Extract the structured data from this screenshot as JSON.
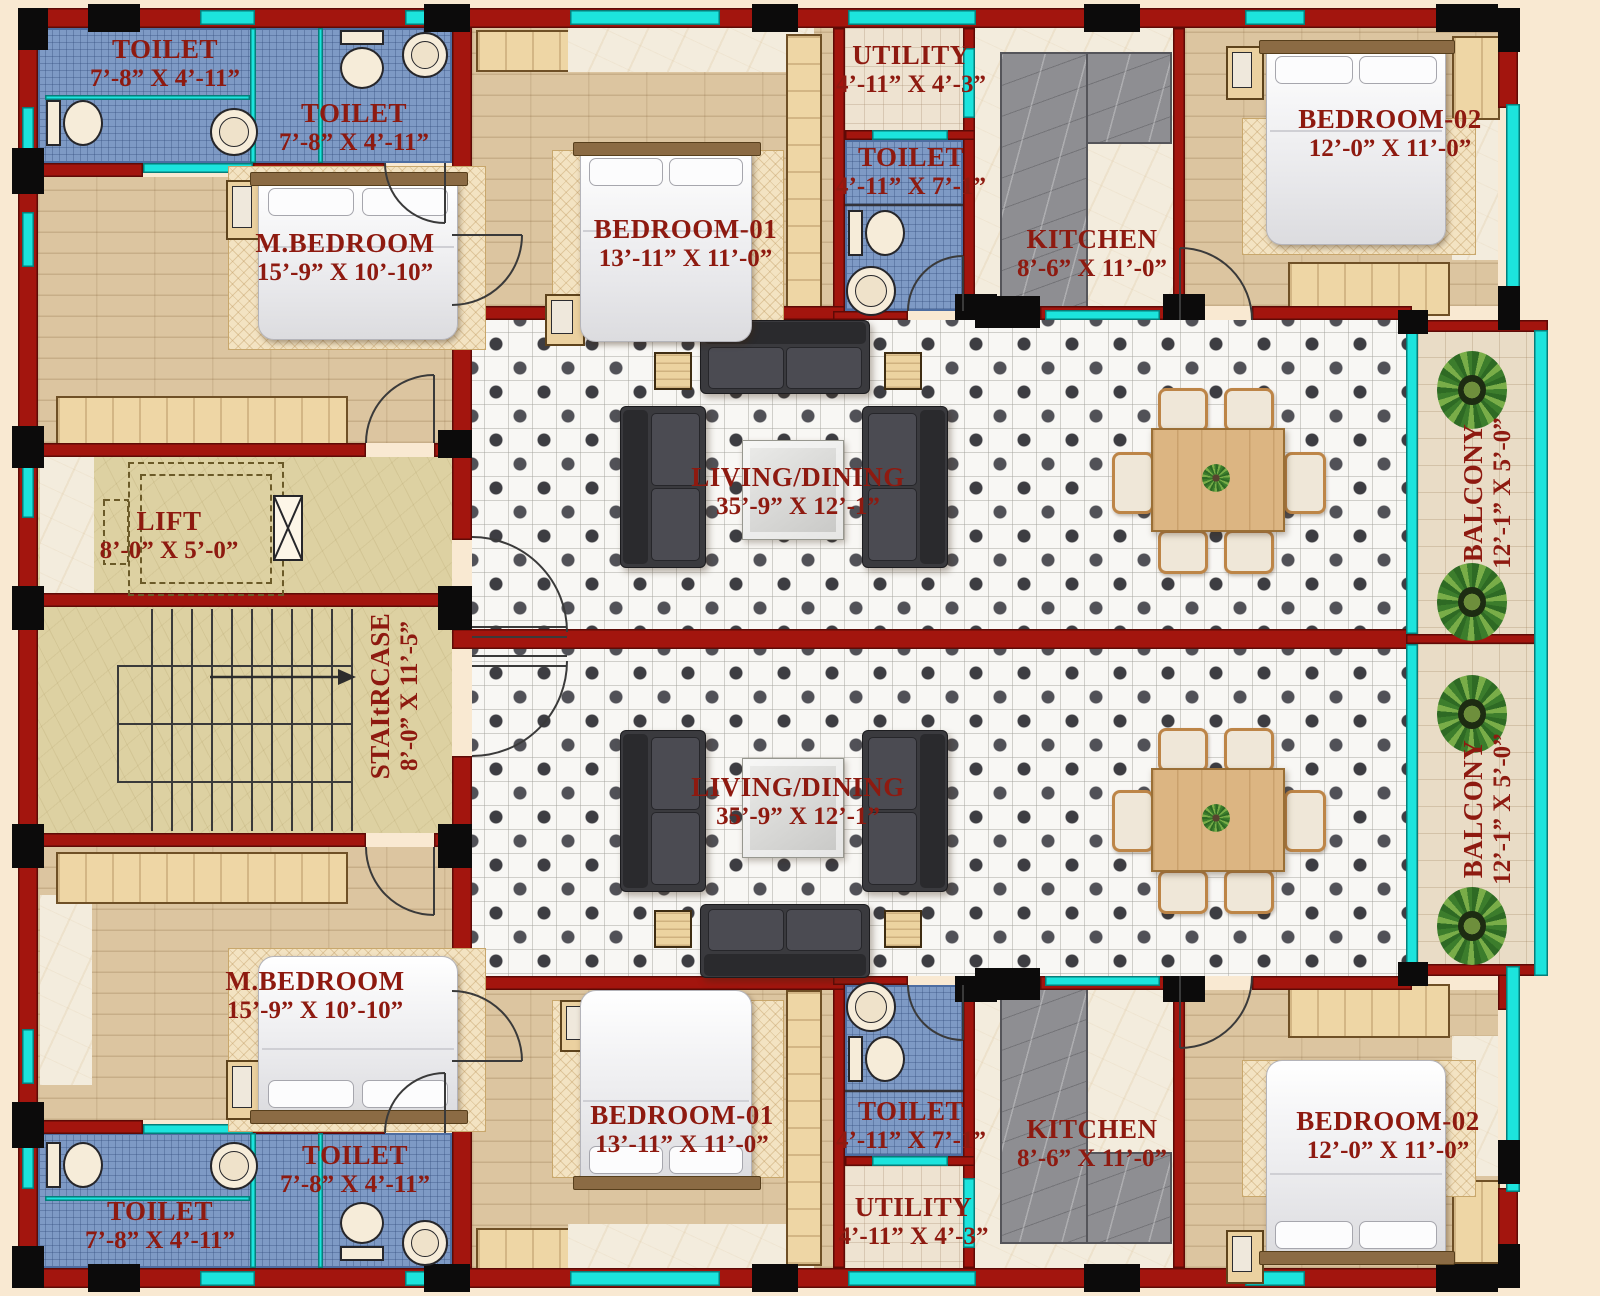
{
  "plan_type": "apartment-floor-plan-two-units",
  "palette": {
    "wall_red": "#a3150e",
    "column_black": "#0c0b0b",
    "window_cyan": "#1ce4dd",
    "label_text": "#8e1a10",
    "toilet_tile_blue": "#7e9ac5",
    "bedroom_wood": "#dcc5a0",
    "stair_sand": "#ddd1a2",
    "marble_cream": "#f3ecdd",
    "kitchen_counter_gray": "#8e8e92",
    "living_tile_white": "#f8f7f4",
    "balcony_tile": "#e9dcc6",
    "background_cream": "#f9e9d2"
  },
  "labels": {
    "toilet_small": {
      "name": "TOILET",
      "dims": "7’-8” X 4’-11”"
    },
    "toilet_long": {
      "name": "TOILET",
      "dims": "4’-11” X 7’-1”"
    },
    "utility": {
      "name": "UTILITY",
      "dims": "4’-11” X 4’-3”"
    },
    "kitchen": {
      "name": "KITCHEN",
      "dims": "8’-6” X 11’-0”"
    },
    "m_bedroom": {
      "name": "M.BEDROOM",
      "dims": "15’-9” X 10’-10”"
    },
    "bedroom_01": {
      "name": "BEDROOM-01",
      "dims": "13’-11” X 11’-0”"
    },
    "bedroom_02": {
      "name": "BEDROOM-02",
      "dims": "12’-0” X 11’-0”"
    },
    "living_dining": {
      "name": "LIVING/DINING",
      "dims": "35’-9” X 12’-1”"
    },
    "balcony": {
      "name": "BALCONY",
      "dims": "12’-1” X 5’-0”"
    },
    "lift": {
      "name": "LIFT",
      "dims": "8’-0” X 5’-0”"
    },
    "staircase": {
      "name": "STAItRCASE",
      "dims": "8’-0” X 11’-5”"
    }
  }
}
